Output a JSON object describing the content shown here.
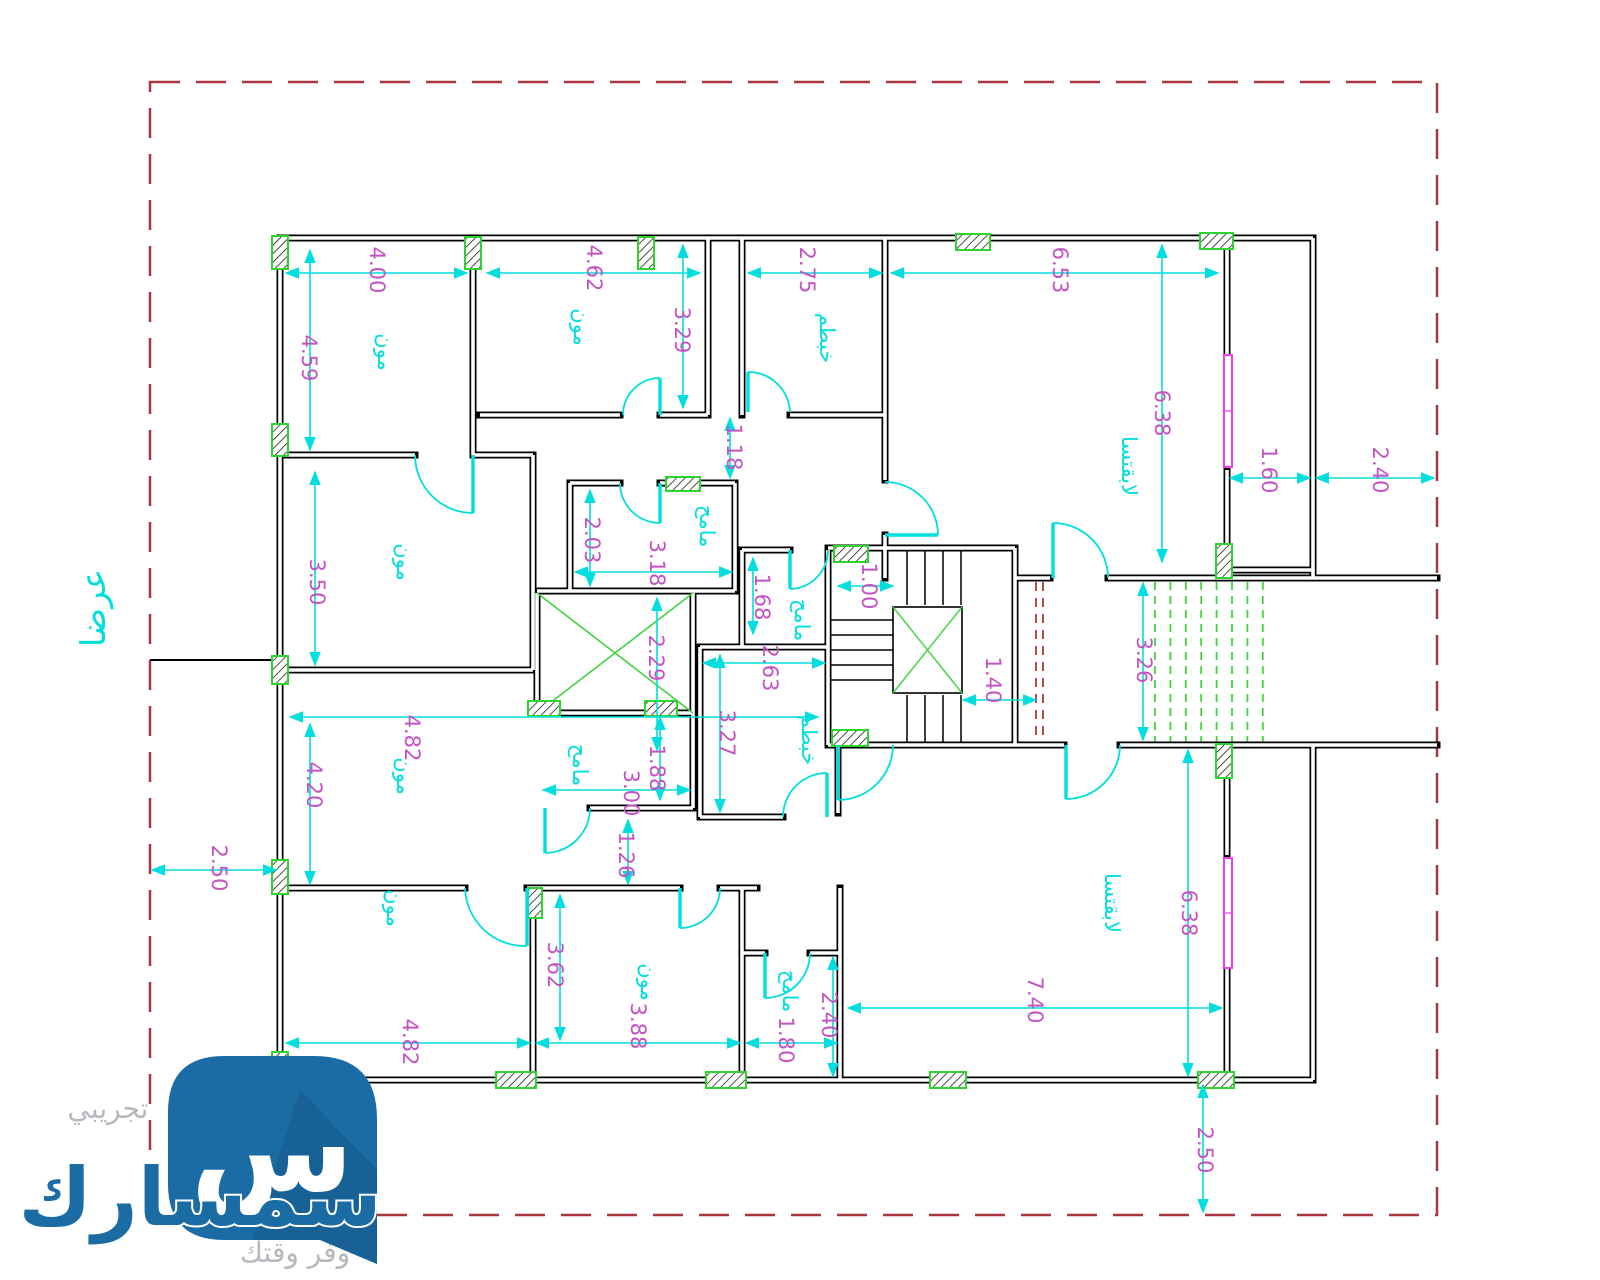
{
  "street_label": "عرضا",
  "watermark": {
    "trial": "تجريبي",
    "brand": "سمسارك",
    "tagline": "وفر وقتك",
    "letter": "س"
  },
  "colors": {
    "wall": "#000000",
    "dimension_line": "#00dede",
    "dimension_text": "#c353c3",
    "room_text": "#00dede",
    "column_green": "#2dd42d",
    "step_dash_green": "#3fd43f",
    "boundary_red": "#a93540",
    "window_magenta": "#ee3cee",
    "logo_blue": "#1b6ba5",
    "gray_text": "#b5b9bd"
  },
  "dimensions": [
    {
      "value": "4.00",
      "x": 370,
      "y": 270
    },
    {
      "value": "4.62",
      "x": 587,
      "y": 268
    },
    {
      "value": "2.75",
      "x": 800,
      "y": 270
    },
    {
      "value": "6.53",
      "x": 1053,
      "y": 270
    },
    {
      "value": "4.59",
      "x": 302,
      "y": 358
    },
    {
      "value": "3.29",
      "x": 675,
      "y": 330
    },
    {
      "value": "6.38",
      "x": 1155,
      "y": 413
    },
    {
      "value": "1.60",
      "x": 1262,
      "y": 470
    },
    {
      "value": "2.40",
      "x": 1373,
      "y": 470
    },
    {
      "value": "1.18",
      "x": 727,
      "y": 447
    },
    {
      "value": "2.03",
      "x": 585,
      "y": 540
    },
    {
      "value": "3.18",
      "x": 650,
      "y": 563
    },
    {
      "value": "3.50",
      "x": 310,
      "y": 582
    },
    {
      "value": "1.68",
      "x": 755,
      "y": 597
    },
    {
      "value": "1.00",
      "x": 862,
      "y": 586
    },
    {
      "value": "2.29",
      "x": 649,
      "y": 658
    },
    {
      "value": "2.63",
      "x": 763,
      "y": 668
    },
    {
      "value": "3.27",
      "x": 720,
      "y": 733
    },
    {
      "value": "1.40",
      "x": 986,
      "y": 680
    },
    {
      "value": "3.26",
      "x": 1137,
      "y": 660
    },
    {
      "value": "4.82",
      "x": 405,
      "y": 738
    },
    {
      "value": "4.20",
      "x": 307,
      "y": 785
    },
    {
      "value": "1.88",
      "x": 650,
      "y": 768
    },
    {
      "value": "3.00",
      "x": 624,
      "y": 793
    },
    {
      "value": "1.26",
      "x": 619,
      "y": 855
    },
    {
      "value": "2.50",
      "x": 212,
      "y": 868
    },
    {
      "value": "3.62",
      "x": 548,
      "y": 965
    },
    {
      "value": "3.88",
      "x": 631,
      "y": 1026
    },
    {
      "value": "1.80",
      "x": 779,
      "y": 1040
    },
    {
      "value": "2.40",
      "x": 822,
      "y": 1015
    },
    {
      "value": "7.40",
      "x": 1028,
      "y": 1000
    },
    {
      "value": "6.38",
      "x": 1182,
      "y": 913
    },
    {
      "value": "2.50",
      "x": 1198,
      "y": 1150
    },
    {
      "value": "4.82",
      "x": 403,
      "y": 1042
    }
  ],
  "rooms": [
    {
      "label": "مون",
      "x": 378,
      "y": 352
    },
    {
      "label": "مون",
      "x": 574,
      "y": 327
    },
    {
      "label": "خبطم",
      "x": 820,
      "y": 338
    },
    {
      "label": "لابقتسا",
      "x": 1122,
      "y": 466
    },
    {
      "label": "مامح",
      "x": 700,
      "y": 526
    },
    {
      "label": "مامح",
      "x": 795,
      "y": 620
    },
    {
      "label": "مون",
      "x": 397,
      "y": 562
    },
    {
      "label": "خبطم",
      "x": 802,
      "y": 740
    },
    {
      "label": "مامح",
      "x": 573,
      "y": 765
    },
    {
      "label": "مون",
      "x": 397,
      "y": 776
    },
    {
      "label": "مون",
      "x": 387,
      "y": 908
    },
    {
      "label": "مون",
      "x": 641,
      "y": 982
    },
    {
      "label": "مامح",
      "x": 783,
      "y": 991
    },
    {
      "label": "لابقتسا",
      "x": 1105,
      "y": 903
    }
  ]
}
